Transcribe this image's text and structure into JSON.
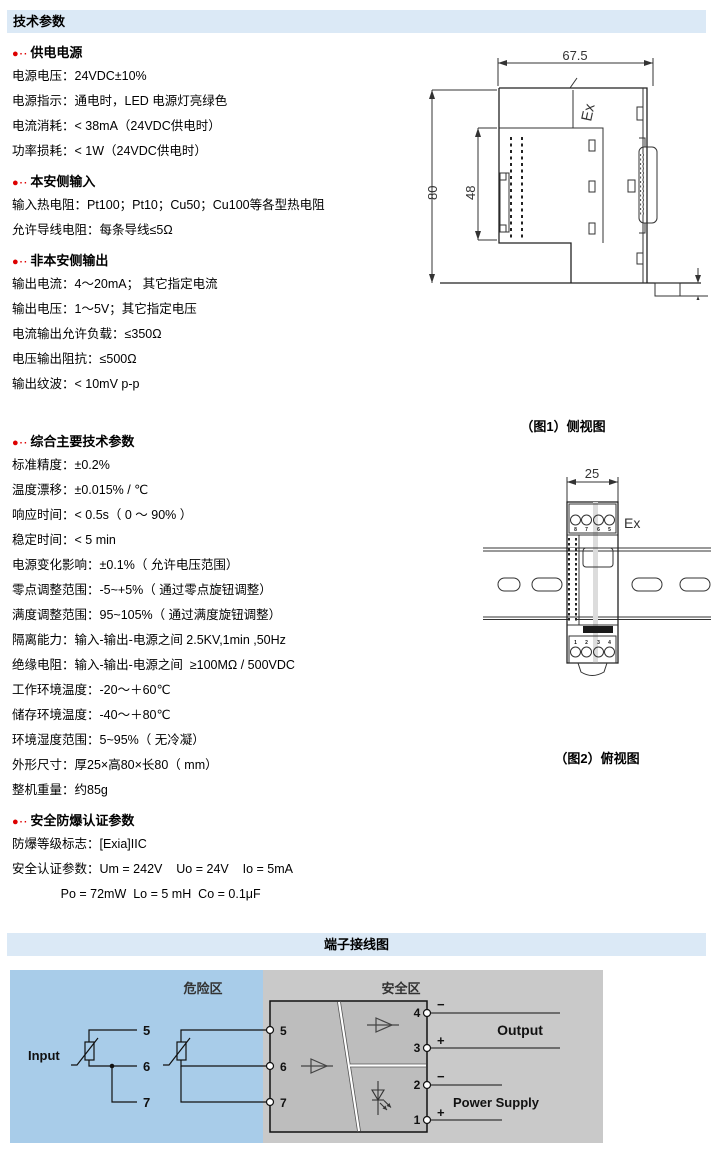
{
  "header": {
    "title": "技术参数"
  },
  "wiring_header": {
    "title": "端子接线图"
  },
  "colors": {
    "header_bar_bg": "#dbe9f6",
    "hazard_bg": "#a8cce9",
    "safe_bg": "#c9c9c9",
    "device_box_bg": "#bdbdbd",
    "bullet_red": "#dd0000"
  },
  "sections": [
    {
      "heading": "供电电源",
      "lines": [
        "电源电压：24VDC±10%",
        "电源指示：通电时，LED 电源灯亮绿色",
        "电流消耗：< 38mA（24VDC供电时）",
        "功率损耗：< 1W（24VDC供电时）"
      ]
    },
    {
      "heading": "本安侧输入",
      "lines": [
        "输入热电阻：Pt100；Pt10；Cu50；Cu100等各型热电阻",
        "允许导线电阻：每条导线≤5Ω"
      ]
    },
    {
      "heading": "非本安侧输出",
      "lines": [
        "输出电流：4～20mA； 其它指定电流",
        "输出电压：1～5V；其它指定电压",
        "电流输出允许负载：≤350Ω",
        "电压输出阻抗：≤500Ω",
        "输出纹波：< 10mV p-p"
      ]
    },
    {
      "heading": "综合主要技术参数",
      "lines": [
        "标准精度：±0.2%",
        "温度漂移：±0.015% / ℃",
        "响应时间：< 0.5s（ 0 ～ 90% ）",
        "稳定时间：< 5 min",
        "电源变化影响：±0.1%（ 允许电压范围）",
        "零点调整范围：-5~+5%（ 通过零点旋钮调整）",
        "满度调整范围：95~105%（ 通过满度旋钮调整）",
        "隔离能力：输入-输出-电源之间 2.5KV,1min ,50Hz",
        "绝缘电阻：输入-输出-电源之间  ≥100MΩ / 500VDC",
        "工作环境温度：-20～＋60℃",
        "储存环境温度：-40～＋80℃",
        "环境湿度范围：5~95%（ 无冷凝）",
        "外形尺寸：厚25×高80×长80（ mm）",
        "整机重量：约85g"
      ]
    },
    {
      "heading": "安全防爆认证参数",
      "lines": [
        "防爆等级标志：[Exia]IIC",
        "安全认证参数：Um = 242V    Uo = 24V    Io = 5mA",
        "              Po = 72mW  Lo = 5 mH  Co = 0.1μF"
      ]
    }
  ],
  "figure1": {
    "caption": "（图1）侧视图",
    "dim_width": "67.5",
    "dim_height": "80",
    "dim_inner": "48",
    "dim_rail": "3.2",
    "ex_label": "Ex"
  },
  "figure2": {
    "caption": "（图2）俯视图",
    "dim_width": "25",
    "ex_label": "Ex",
    "top_terminal_numbers": [
      "8",
      "7",
      "6",
      "5"
    ],
    "bottom_terminal_numbers": [
      "1",
      "2",
      "3",
      "4"
    ]
  },
  "wiring": {
    "hazard_zone": "危险区",
    "safe_zone": "安全区",
    "input_label": "Input",
    "output_label": "Output",
    "power_label": "Power Supply",
    "stub_terminals": [
      "5",
      "6",
      "7"
    ],
    "box_left_terminals": [
      "5",
      "6",
      "7"
    ],
    "box_right_terminals": [
      "4",
      "3",
      "2",
      "1"
    ],
    "plus": "+",
    "minus": "−"
  }
}
